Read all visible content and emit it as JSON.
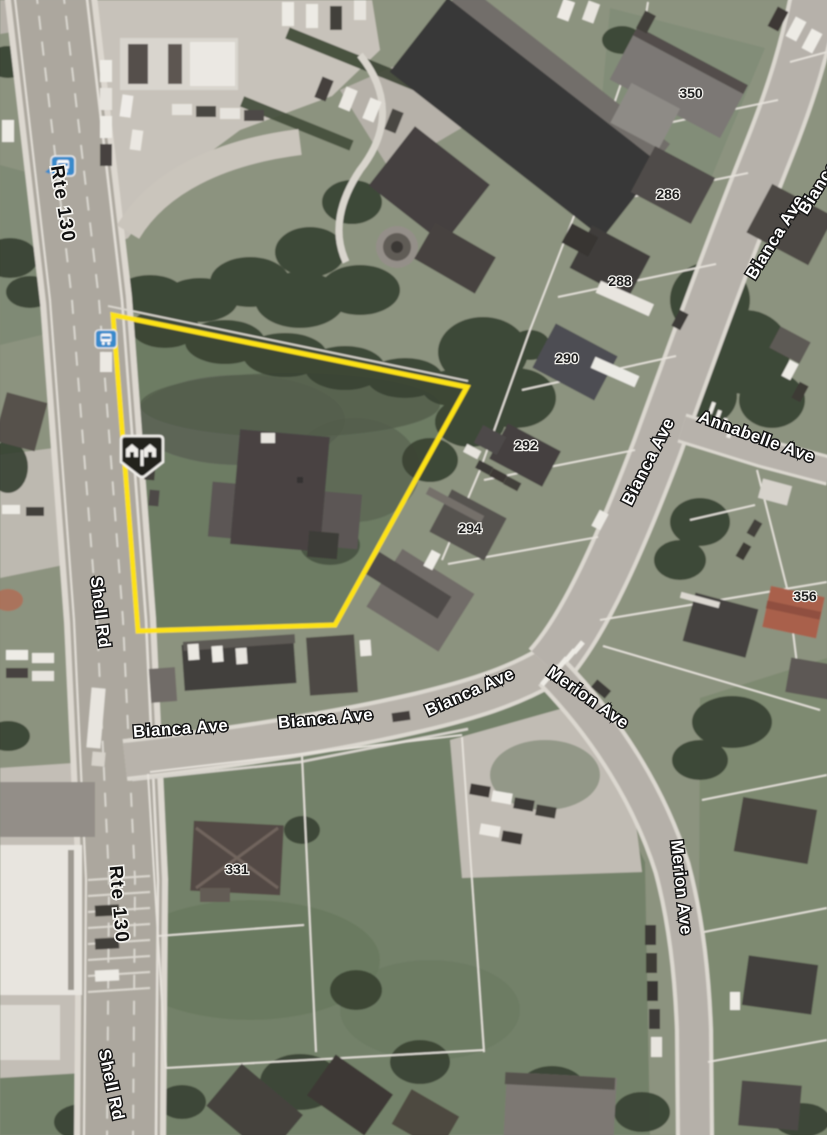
{
  "map": {
    "streets": {
      "route_labels": [
        "Rte 130",
        "Rte 130"
      ],
      "shell_rd_labels": [
        "Shell Rd",
        "Shell Rd"
      ],
      "bianca_ave_labels": [
        "Bianca Ave",
        "Bianca Ave",
        "Bianca Ave",
        "Bianca Ave",
        "Bianca Ave",
        "Bianca Ave"
      ],
      "annabelle_ave_label": "Annabelle Ave",
      "merion_ave_labels": [
        "Merion Ave",
        "Merion Ave"
      ]
    },
    "house_numbers": [
      "350",
      "286",
      "288",
      "290",
      "292",
      "294",
      "356",
      "331"
    ],
    "icons": {
      "bus_stop": "bus-stop-icon",
      "neighborhood_marker": "houses-badge-icon"
    },
    "colors": {
      "parcel_boundary_yellow": "#ffe409",
      "bus_icon_blue": "#2f86cc",
      "road_gray": "#aaa69e",
      "lawn_green": "#6d7c63",
      "tree_dark_green": "#2f3a2b"
    }
  }
}
